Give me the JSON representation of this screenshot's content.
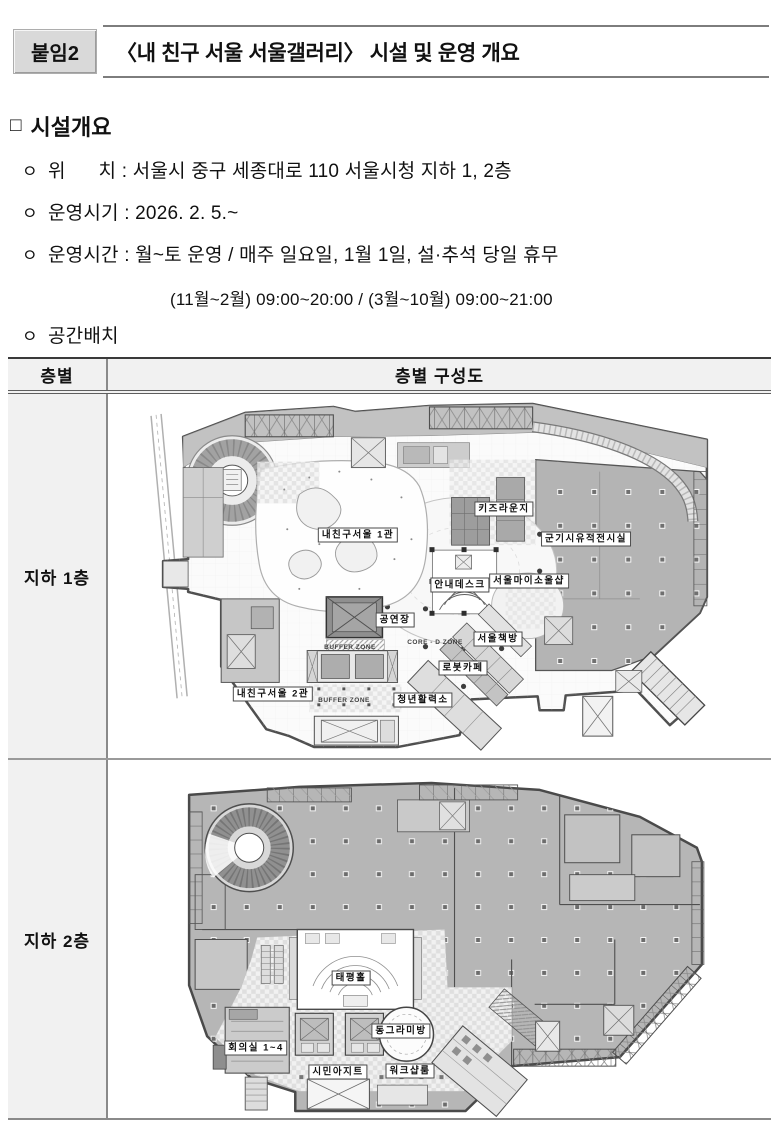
{
  "header": {
    "badge": "붙임2",
    "title": "〈내 친구 서울 서울갤러리〉 시설 및 운영 개요"
  },
  "overview": {
    "marker": "□",
    "heading": "시설개요",
    "bullets": [
      {
        "m": "ㅇ",
        "t": "위      치 : 서울시 중구 세종대로 110 서울시청 지하 1, 2층"
      },
      {
        "m": "ㅇ",
        "t": "운영시기 : 2026. 2. 5.~"
      },
      {
        "m": "ㅇ",
        "t": "운영시간 : 월~토 운영 / 매주 일요일, 1월 1일, 설·추석 당일 휴무"
      },
      {
        "m": "",
        "t": "(11월~2월) 09:00~20:00 / (3월~10월) 09:00~21:00"
      },
      {
        "m": "ㅇ",
        "t": "공간배치"
      }
    ]
  },
  "table": {
    "col_floor": "층별",
    "col_plan": "층별 구성도",
    "b1": {
      "floor": "지하 1층",
      "labels": {
        "kids": "키즈라운지",
        "gungisi": "군기시유적전시실",
        "hall1": "내친구서울 1관",
        "infodesk": "안내데스크",
        "soulshop": "서울마이소울샵",
        "stage": "공연장",
        "bookstore": "서울책방",
        "robotcafe": "로봇카페",
        "youth": "청년활력소",
        "hall2": "내친구서울 2관",
        "buffer1": "BUFFER ZONE",
        "buffer2": "BUFFER ZONE",
        "core": "CORE - D ZONE"
      }
    },
    "b2": {
      "floor": "지하 2층",
      "labels": {
        "taepyeong": "태평홀",
        "circle": "동그라미방",
        "meeting": "회의실 1~4",
        "citizen": "시민아지트",
        "workshop": "워크샵룸"
      }
    }
  }
}
